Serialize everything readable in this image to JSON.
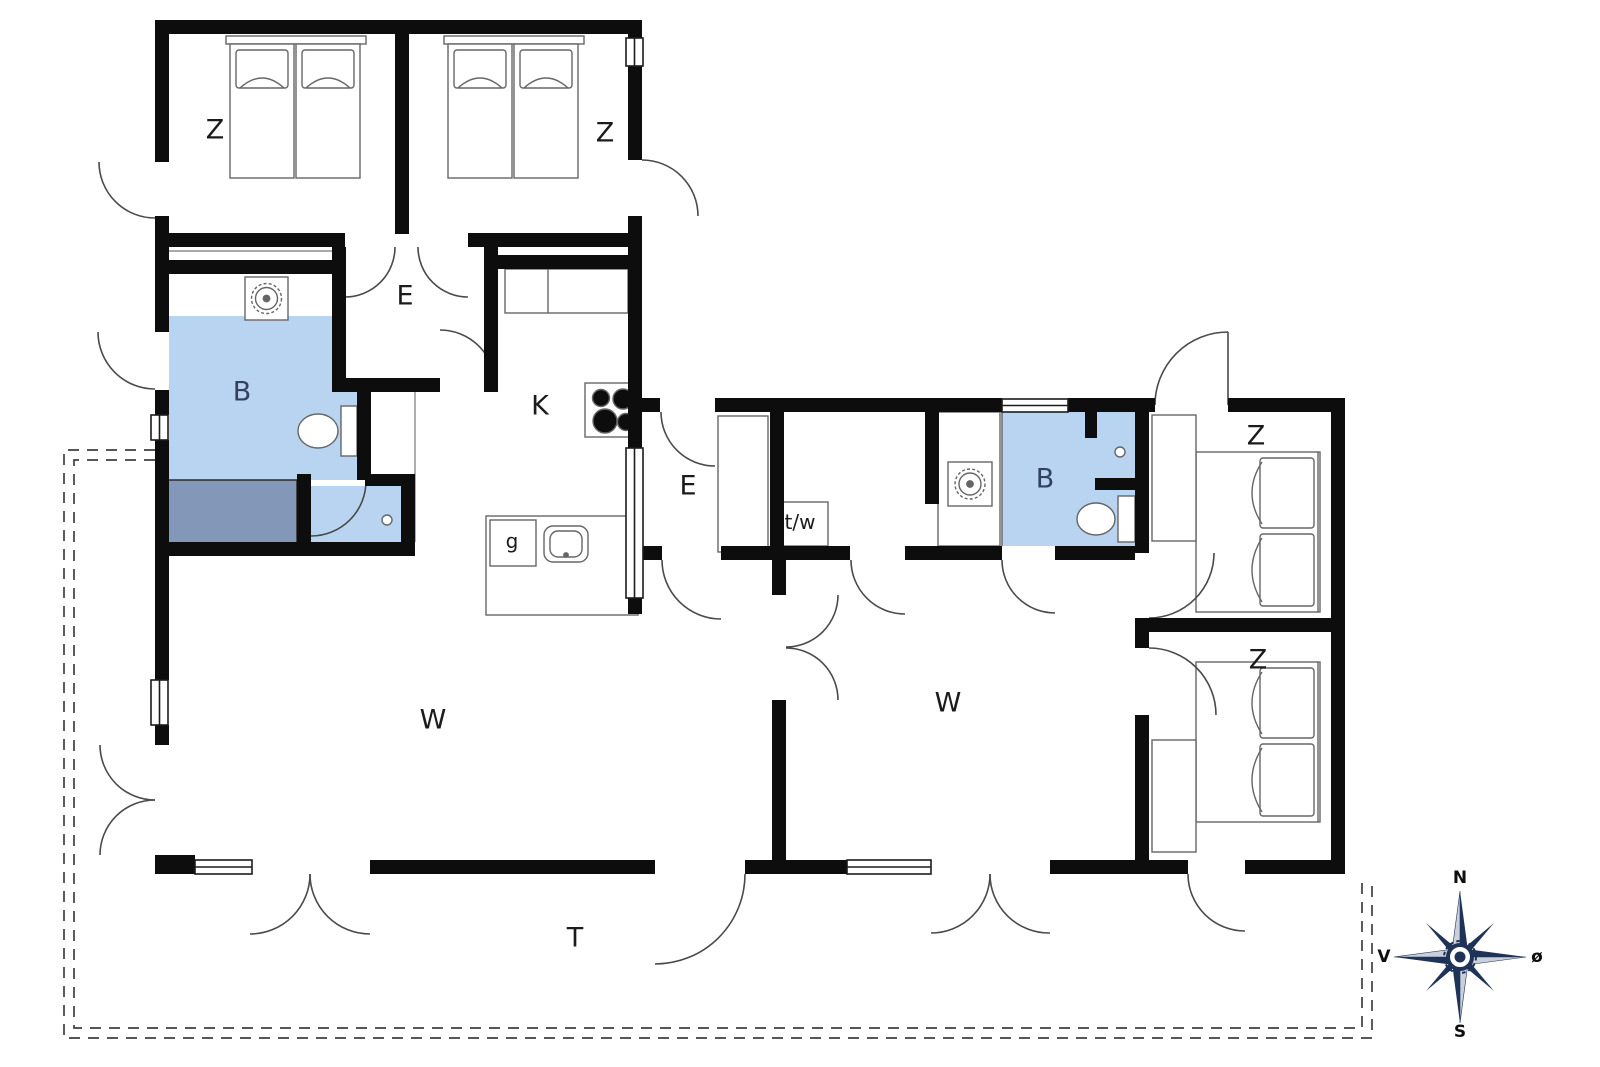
{
  "plan": {
    "type": "holiday-house floor plan",
    "rooms": {
      "bedroom_nw": {
        "label": "Z"
      },
      "bedroom_n": {
        "label": "Z"
      },
      "entry_north": {
        "label": "E"
      },
      "bathroom_west": {
        "label": "B"
      },
      "kitchen": {
        "label": "K"
      },
      "hall_middle": {
        "label": "E"
      },
      "toilet_wash": {
        "label": "t/w"
      },
      "pantry": {
        "label": "g"
      },
      "bathroom_east": {
        "label": "B"
      },
      "bedroom_ne": {
        "label": "Z"
      },
      "bedroom_se": {
        "label": "Z"
      },
      "living_west": {
        "label": "W"
      },
      "living_east": {
        "label": "W"
      },
      "terrace": {
        "label": "T"
      }
    },
    "compass": {
      "north": "N",
      "south": "S",
      "west": "V",
      "east": "ø"
    },
    "colors": {
      "wall": "#0d0d0d",
      "bathroom_fill": "#b9d4f1",
      "bathtub_fill": "#8398b8",
      "compass_dark": "#1e3357",
      "compass_light": "#c9cfdb",
      "door_line": "#4a4a4a",
      "terrace_dash": "#3f3f3f"
    },
    "icons": {
      "washing_machine": "square with scalloped drum circle",
      "stove": "four black burner circles",
      "sink": "rounded basin",
      "toilet": "bowl with cistern",
      "shower_head": "small circle",
      "compass_rose": "eight point star N/S/V/ø"
    }
  }
}
